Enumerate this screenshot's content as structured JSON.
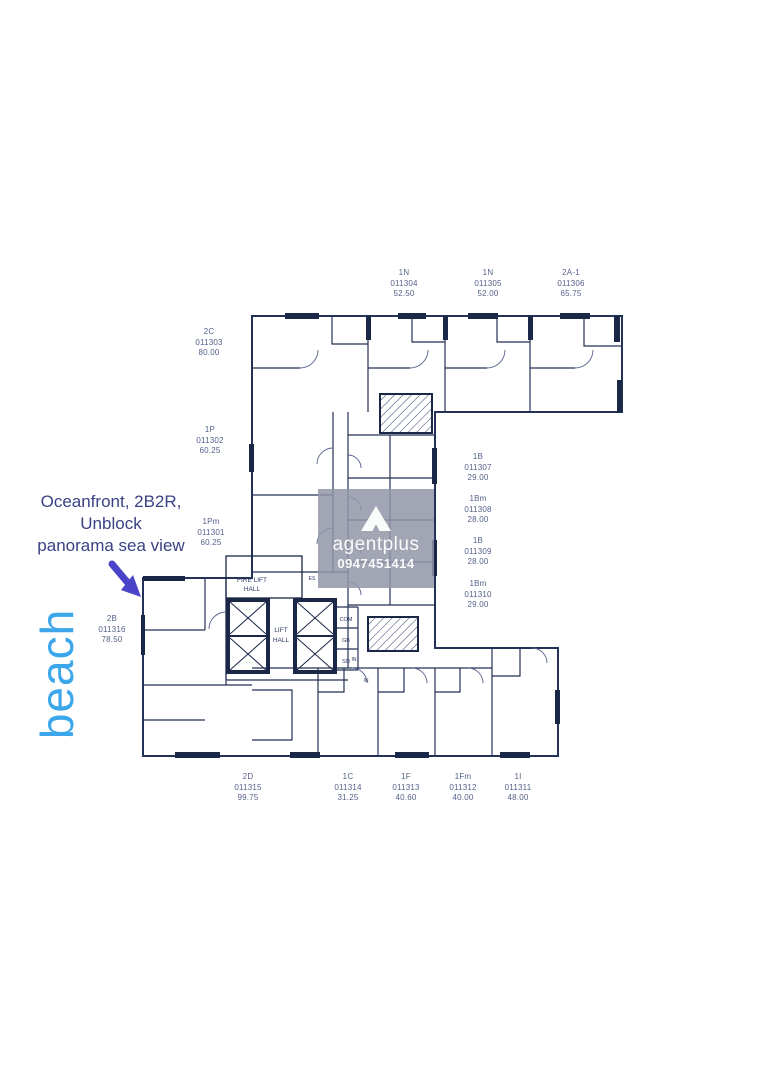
{
  "annotation": {
    "lines": [
      "Oceanfront, 2B2R,",
      "Unblock",
      "panorama sea view"
    ],
    "color": "#3a4284"
  },
  "beach": {
    "text": "beach",
    "color": "#3ba6ea"
  },
  "arrow": {
    "color": "#4a44cb"
  },
  "watermark": {
    "brand": "agentplus",
    "phone": "0947451414",
    "box_color": "#9297a7"
  },
  "plan": {
    "line_color": "#243158",
    "thick_color": "#1a2747",
    "label_color": "#55618b"
  },
  "rooms": {
    "fire_lift_hall": [
      "FIRE LIFT",
      "HALL"
    ],
    "lift_hall": [
      "LIFT",
      "HALL"
    ],
    "com": "COM",
    "gb": "GB",
    "sn": "SN",
    "es": "ES",
    "in1": "IN",
    "in2": "IN"
  },
  "units": [
    {
      "type": "2C",
      "id": "011303",
      "area": "80.00"
    },
    {
      "type": "1P",
      "id": "011302",
      "area": "60.25"
    },
    {
      "type": "1Pm",
      "id": "011301",
      "area": "60.25"
    },
    {
      "type": "2B",
      "id": "011316",
      "area": "78.50"
    },
    {
      "type": "1N",
      "id": "011304",
      "area": "52.50"
    },
    {
      "type": "1N",
      "id": "011305",
      "area": "52.00"
    },
    {
      "type": "2A-1",
      "id": "011306",
      "area": "65.75"
    },
    {
      "type": "1B",
      "id": "011307",
      "area": "29.00"
    },
    {
      "type": "1Bm",
      "id": "011308",
      "area": "28.00"
    },
    {
      "type": "1B",
      "id": "011309",
      "area": "28.00"
    },
    {
      "type": "1Bm",
      "id": "011310",
      "area": "29.00"
    },
    {
      "type": "2D",
      "id": "011315",
      "area": "99.75"
    },
    {
      "type": "1C",
      "id": "011314",
      "area": "31.25"
    },
    {
      "type": "1F",
      "id": "011313",
      "area": "40.60"
    },
    {
      "type": "1Fm",
      "id": "011312",
      "area": "40.00"
    },
    {
      "type": "1I",
      "id": "011311",
      "area": "48.00"
    }
  ]
}
